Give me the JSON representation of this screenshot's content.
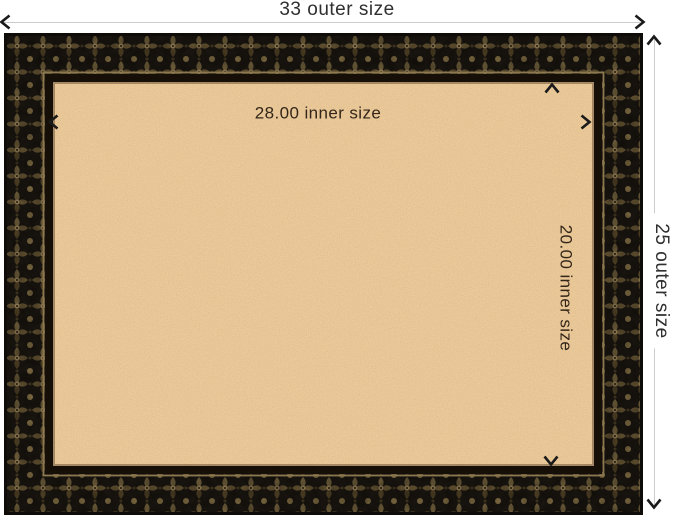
{
  "page": {
    "background": "#ffffff"
  },
  "labels": {
    "outer_width": "33 outer size",
    "outer_height": "25 outer size",
    "inner_width": "28.00 inner size",
    "inner_height": "20.00 inner size"
  },
  "colors": {
    "dimension_line": "#cccccc",
    "arrow": "#1a1a1a",
    "outer_label_text": "#2f2f2f",
    "inner_label_text": "#332619",
    "cork": "#cf9858",
    "frame_base": "#1c1711",
    "frame_accent": "#8a7549",
    "frame_lip": "#150f08"
  },
  "icons": {
    "arrow_left": "‹",
    "arrow_right": "›",
    "arrow_up": "ˆ",
    "arrow_down": "ˇ"
  }
}
